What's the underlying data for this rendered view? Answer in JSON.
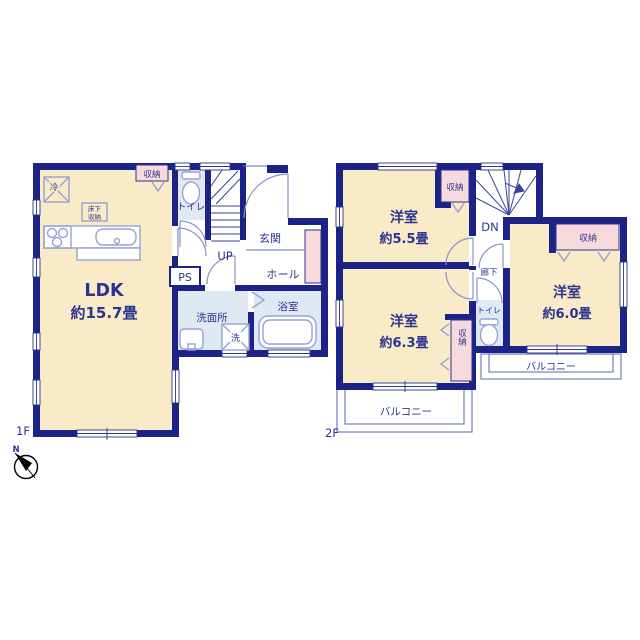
{
  "floor1": {
    "label": "1F",
    "ldk": {
      "name": "LDK",
      "size": "約15.7畳"
    },
    "genkan": "玄関",
    "hall": "ホール",
    "toilet": "トイレ",
    "stairs_up": "UP",
    "ps": "PS",
    "washroom": "洗面所",
    "laundry": "洗",
    "bathroom": "浴室",
    "storage": "収納",
    "fridge": "冷",
    "underfloor_storage": {
      "line1": "床下",
      "line2": "収納"
    }
  },
  "floor2": {
    "label": "2F",
    "room_55": {
      "name": "洋室",
      "size": "約5.5畳"
    },
    "room_63": {
      "name": "洋室",
      "size": "約6.3畳"
    },
    "room_60": {
      "name": "洋室",
      "size": "約6.0畳"
    },
    "storage_55": "収納",
    "storage_60": "収納",
    "storage_63": "収納",
    "stairs_down": "DN",
    "hallway": "廊下",
    "toilet": "トイレ",
    "balcony_left": "バルコニー",
    "balcony_right": "バルコニー"
  },
  "compass": {
    "north": "N"
  },
  "colors": {
    "wall": "#1c2386",
    "room_cream": "#f9ebc8",
    "room_blue": "#dfe9f3",
    "closet_pink": "#f8d9de",
    "text": "#2b3490"
  }
}
